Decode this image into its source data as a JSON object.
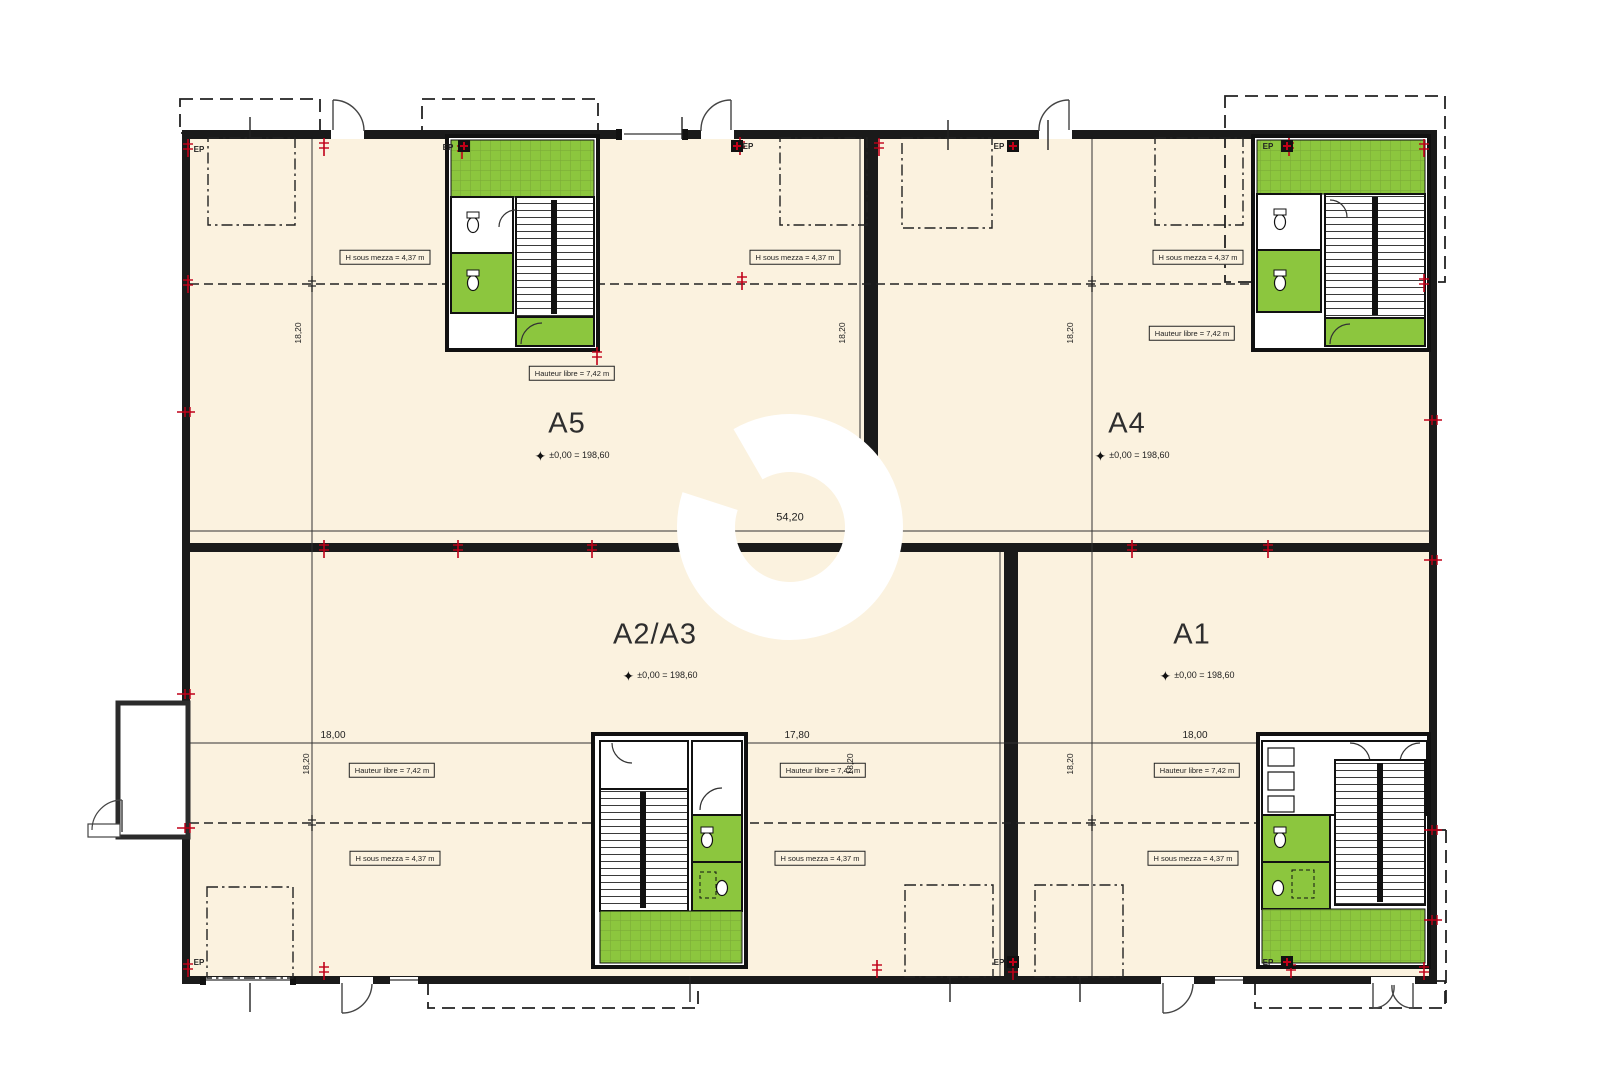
{
  "units": [
    {
      "name": "A5",
      "level": "±0,00 = 198,60"
    },
    {
      "name": "A4",
      "level": "±0,00 = 198,60"
    },
    {
      "name": "A2/A3",
      "level": "±0,00 = 198,60"
    },
    {
      "name": "A1",
      "level": "±0,00 = 198,60"
    }
  ],
  "labels": {
    "h_sous_mezza": "H sous mezza = 4,37 m",
    "hauteur_libre": "Hauteur libre = 7,42 m",
    "ep": "EP"
  },
  "dimensions": {
    "overall": "54,20",
    "bay_left": "18,00",
    "bay_center": "17,80",
    "bay_right": "18,00",
    "depth": "18,20"
  },
  "icons": {
    "level_datum_star": "✦"
  },
  "colors": {
    "floor": "#FBF2DF",
    "green": "#8CC63E",
    "green_grid": "#79A737",
    "wall": "#1A1A1A",
    "marker_red": "#C00018",
    "watermark": "#FFFFFF"
  }
}
